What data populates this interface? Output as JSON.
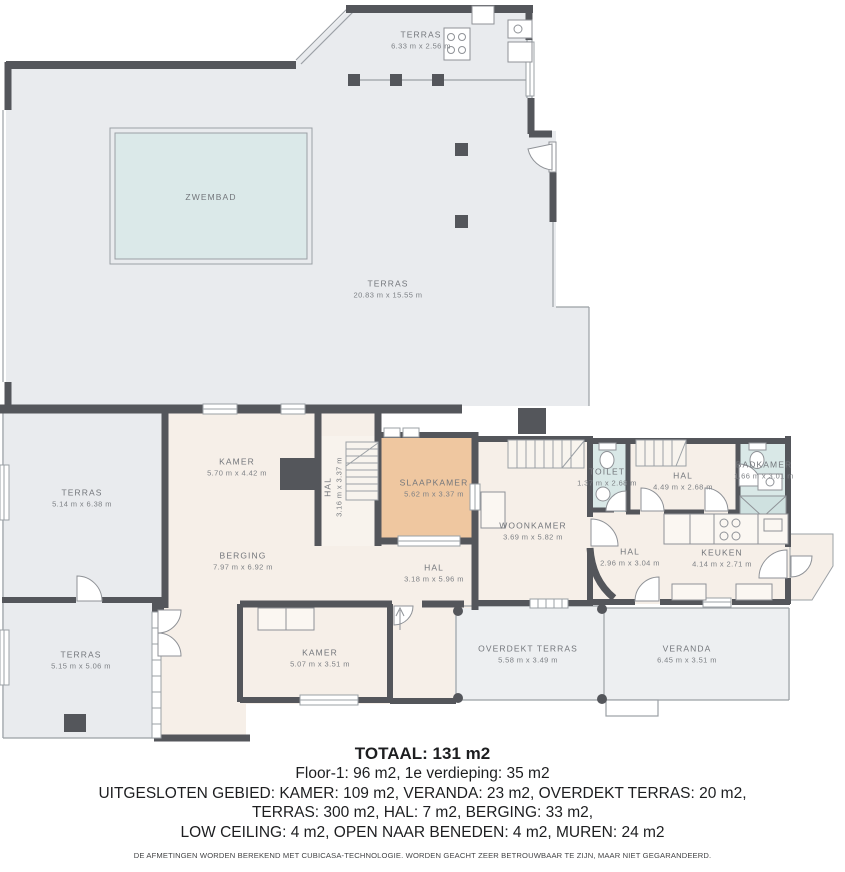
{
  "rooms": [
    {
      "name": "TERRAS",
      "dims": "6.33 m x 2.56 m"
    },
    {
      "name": "ZWEMBAD",
      "dims": ""
    },
    {
      "name": "TERRAS",
      "dims": "20.83 m x 15.55 m"
    },
    {
      "name": "TERRAS",
      "dims": "5.14 m x 6.38 m"
    },
    {
      "name": "KAMER",
      "dims": "5.70 m x 4.42 m"
    },
    {
      "name": "HAL",
      "dims": "3.16 m x 3.37 m"
    },
    {
      "name": "SLAAPKAMER",
      "dims": "5.62 m x 3.37 m"
    },
    {
      "name": "WOONKAMER",
      "dims": "3.69 m x 5.82 m"
    },
    {
      "name": "TOILET",
      "dims": "1.37 m x 2.68 m"
    },
    {
      "name": "HAL",
      "dims": "4.49 m x 2.68 m"
    },
    {
      "name": "BADKAMER",
      "dims": "1.66 m x 3.01 m"
    },
    {
      "name": "HAL",
      "dims": "2.96 m x 3.04 m"
    },
    {
      "name": "KEUKEN",
      "dims": "4.14 m x 2.71 m"
    },
    {
      "name": "BERGING",
      "dims": "7.97 m x 6.92 m"
    },
    {
      "name": "HAL",
      "dims": "3.18 m x 5.96 m"
    },
    {
      "name": "TERRAS",
      "dims": "5.15 m x 5.06 m"
    },
    {
      "name": "KAMER",
      "dims": "5.07 m x 3.51 m"
    },
    {
      "name": "OVERDEKT TERRAS",
      "dims": "5.58 m x 3.49 m"
    },
    {
      "name": "VERANDA",
      "dims": "6.45 m x 3.51 m"
    }
  ],
  "summary": {
    "total": "TOTAAL: 131 m2",
    "line1": "Floor-1: 96 m2, 1e verdieping: 35 m2",
    "line2": "UITGESLOTEN GEBIED: KAMER: 109 m2, VERANDA: 23 m2, OVERDEKT TERRAS: 20 m2,",
    "line3": "TERRAS: 300 m2, HAL: 7 m2, BERGING: 33 m2,",
    "line4": "LOW CEILING: 4 m2, OPEN NAAR BENEDEN: 4 m2, MUREN: 24 m2",
    "disclaimer": "DE AFMETINGEN WORDEN BEREKEND MET CUBICASA-TECHNOLOGIE. WORDEN GEACHT ZEER BETROUWBAAR TE ZIJN, MAAR NIET GEGARANDEERD."
  },
  "colors": {
    "wall": "#54565b",
    "terrace_fill": "#e9ebee",
    "room_fill": "#f6efe8",
    "highlight_room_fill": "#efc7a0",
    "wet_room_fill": "#d9e8e7",
    "pool_fill": "#dbe9e9",
    "label_text": "#73767b",
    "summary_text": "#1d1e20"
  }
}
